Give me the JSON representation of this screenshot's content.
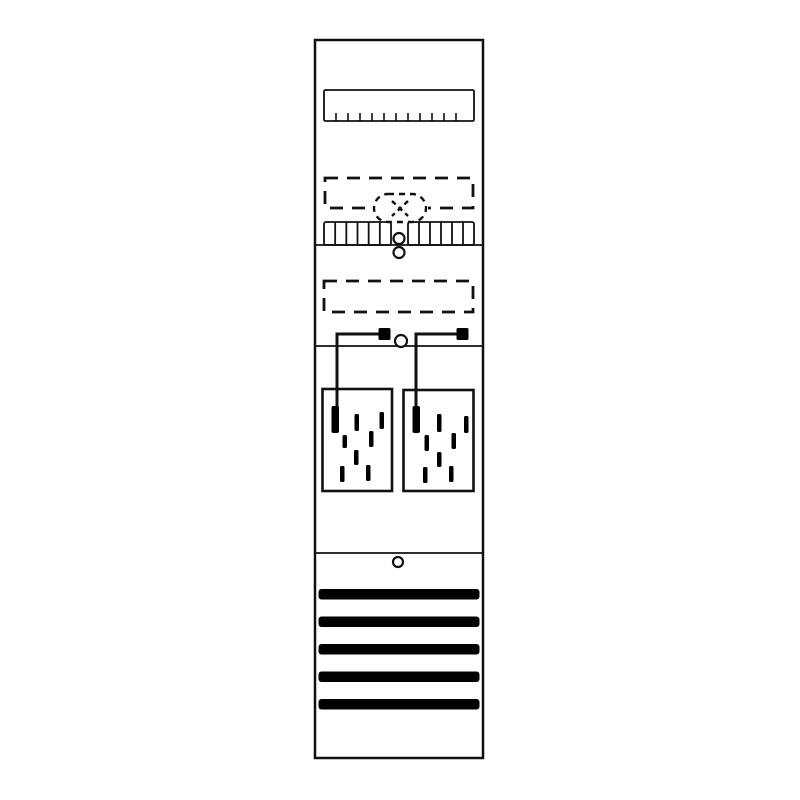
{
  "figure": {
    "name": "meter-panel-technical-diagram",
    "canvas_width": 800,
    "canvas_height": 800,
    "background_color": "#ffffff",
    "stroke_color": "#111111",
    "fill_color": "#000000"
  },
  "panel": {
    "name": "panel-outline",
    "x": 315,
    "y": 40,
    "width": 168,
    "height": 718,
    "stroke_width": 2.5,
    "dividers": {
      "name": "section-divider",
      "ys": [
        245,
        346,
        553
      ],
      "stroke_width": 1.8
    }
  },
  "din_rail": {
    "name": "din-rail",
    "x": 324,
    "y": 90,
    "width": 150,
    "height": 31,
    "stroke_width": 1.8,
    "ticks": {
      "name": "din-rail-tick",
      "count": 11,
      "start_x": 336,
      "spacing": 12,
      "height": 8,
      "stroke_width": 1.6
    }
  },
  "dashed_modules": [
    {
      "name": "dashed-module-outline",
      "x": 325,
      "y": 178,
      "width": 148,
      "height": 30
    },
    {
      "name": "dashed-module-outline",
      "x": 324,
      "y": 281,
      "width": 149,
      "height": 31
    }
  ],
  "dashed_module_style": {
    "stroke_width": 2.8,
    "dash": "13 9"
  },
  "seal_badge": {
    "name": "seal-badge",
    "x": 374,
    "y": 194,
    "width": 52,
    "height": 28,
    "radius": 14,
    "stroke_width": 2.4,
    "dash": "6 5",
    "cross": {
      "name": "seal-cross-icon",
      "x1": 392,
      "y1": 201,
      "x2": 408,
      "y2": 216,
      "dash": "5 4"
    }
  },
  "terminal_strips": [
    {
      "name": "terminal-strip",
      "x": 324,
      "y": 222,
      "width": 67,
      "height": 23,
      "cells": 6
    },
    {
      "name": "terminal-strip",
      "x": 408,
      "y": 222,
      "width": 66,
      "height": 23,
      "cells": 6
    }
  ],
  "terminal_strip_style": {
    "stroke_width": 1.8
  },
  "screw_holes": [
    {
      "name": "screw-hole",
      "cx": 399,
      "cy": 238.5,
      "r": 5.5
    },
    {
      "name": "screw-hole",
      "cx": 399,
      "cy": 252.5,
      "r": 5.5
    },
    {
      "name": "screw-hole",
      "cx": 401,
      "cy": 341,
      "r": 6
    },
    {
      "name": "screw-hole",
      "cx": 398,
      "cy": 562,
      "r": 5
    }
  ],
  "screw_hole_style": {
    "stroke_width": 2.2
  },
  "meter_circuits": [
    {
      "plate": {
        "name": "meter-plate",
        "x": 322.5,
        "y": 389,
        "width": 69.5,
        "height": 102,
        "stroke_width": 2.6
      },
      "wire": {
        "name": "meter-wire",
        "path": "M 380 334 L 337 334 L 337 412",
        "stroke_width": 3
      },
      "connector": {
        "name": "wire-connector",
        "x": 378.5,
        "y": 328,
        "width": 12,
        "height": 12
      },
      "terminal": {
        "name": "wire-terminal",
        "x": 331.5,
        "y": 406,
        "width": 7.5,
        "height": 27
      },
      "dashes": [
        {
          "x": 354.5,
          "y": 414,
          "h": 17
        },
        {
          "x": 379.5,
          "y": 412,
          "h": 17
        },
        {
          "x": 342.5,
          "y": 435,
          "h": 13
        },
        {
          "x": 369,
          "y": 431,
          "h": 16
        },
        {
          "x": 354,
          "y": 450,
          "h": 15
        },
        {
          "x": 340,
          "y": 466,
          "h": 16
        },
        {
          "x": 366,
          "y": 465,
          "h": 16
        }
      ]
    },
    {
      "plate": {
        "name": "meter-plate",
        "x": 403.5,
        "y": 390,
        "width": 70,
        "height": 101,
        "stroke_width": 2.6
      },
      "wire": {
        "name": "meter-wire",
        "path": "M 458 334 L 416 334 L 416 412",
        "stroke_width": 3
      },
      "connector": {
        "name": "wire-connector",
        "x": 456.5,
        "y": 328,
        "width": 12,
        "height": 12
      },
      "terminal": {
        "name": "wire-terminal",
        "x": 412.5,
        "y": 406,
        "width": 7.5,
        "height": 27
      },
      "dashes": [
        {
          "x": 437,
          "y": 414,
          "h": 18
        },
        {
          "x": 464,
          "y": 416,
          "h": 17
        },
        {
          "x": 424.5,
          "y": 435,
          "h": 16
        },
        {
          "x": 451.5,
          "y": 433,
          "h": 16
        },
        {
          "x": 437,
          "y": 452,
          "h": 15
        },
        {
          "x": 423,
          "y": 467,
          "h": 16
        },
        {
          "x": 449,
          "y": 466,
          "h": 16
        }
      ]
    }
  ],
  "meter_dash_style": {
    "name": "meter-dash-mark",
    "width": 4.5,
    "radius": 1.5
  },
  "vent_slots": {
    "name": "vent-slot",
    "x": 318.5,
    "width": 161,
    "height": 10.5,
    "radius": 3,
    "ys": [
      589,
      616.5,
      644,
      671.5,
      699
    ]
  }
}
